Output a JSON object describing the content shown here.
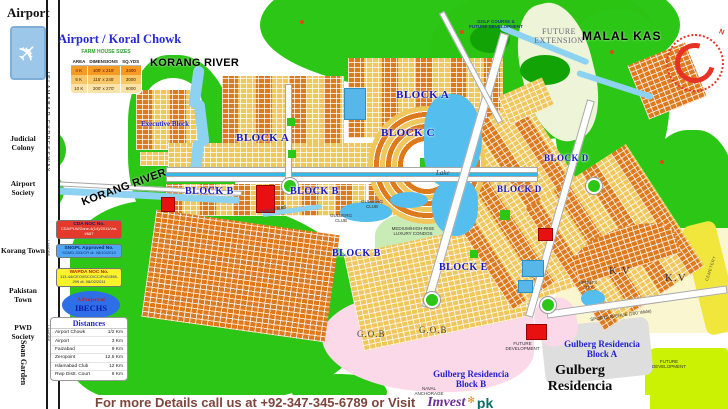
{
  "panel": {
    "airport": "Airport",
    "title": "Airport / Koral Chowk",
    "farm_table": {
      "caption": "FARM HOUSE SIZES",
      "headers": [
        "AREA",
        "DIMENSIONS",
        "SQ.YDS"
      ],
      "rows": [
        [
          "4 K",
          "100' x 216'",
          "2400"
        ],
        [
          "5 K",
          "115' x 245'",
          "3000"
        ],
        [
          "10 K",
          "200' x 270'",
          "6000"
        ]
      ]
    }
  },
  "left_strip": {
    "expressway": "ISLAMABAD EXPRESSWAY",
    "direction_tag": "LAHORE",
    "localities": [
      "Judicial\nColony",
      "Airport\nSociety",
      "Korang Town",
      "Pakistan Town",
      "PWD\nSociety",
      "Soan Garden"
    ]
  },
  "noc": [
    {
      "title": "CDA NOC No.",
      "detail": "CDA/PLW/Zone-4(14)/2011/Vol-I/687"
    },
    {
      "title": "SNGPL Approved No.",
      "detail": "SGMD-333/CR dt. 08/10/2010"
    },
    {
      "title": "WAPDA NOC No.",
      "detail": "113-44/CEO/ISCO/CC/PdG/398-299 dt. 08/02/2011"
    }
  ],
  "project_badge": {
    "line1": "A Project of",
    "line2": "IBECHS"
  },
  "distances": {
    "title": "Distances",
    "rows": [
      [
        "Airport Chowk",
        "1/2 Km"
      ],
      [
        "Airport",
        "3 Km"
      ],
      [
        "Faizabad",
        "9 Km"
      ],
      [
        "Zeropoint",
        "12.5 Km"
      ],
      [
        "Islamabad Club",
        "12 Km"
      ],
      [
        "Rwp Distt. Court",
        "8 Km"
      ]
    ]
  },
  "footer": {
    "text": "For more Details call us at +92-347-345-6789 or Visit",
    "logo_text": "Imvest",
    "logo_flower": "✻",
    "logo_suffix": "pk"
  },
  "map": {
    "compass_north": "N",
    "colors": {
      "green": "#2CC716",
      "plot_orange": "#DD7A1E",
      "plot_sand": "#EFC75D",
      "water": "#54BFEE",
      "gob_pink": "#FBD9E9",
      "future_chartreuse": "#CCF203",
      "title_blue": "#2828D8",
      "block_label_blue": "#1818C8"
    },
    "labels": [
      {
        "name": "korang-river-top-label",
        "text": "KORANG RIVER",
        "x": 150,
        "y": 57,
        "cls": "c-river"
      },
      {
        "name": "korang-river-left-label",
        "text": "KORANG RIVER",
        "x": 80,
        "y": 197,
        "cls": "c-river",
        "rot": -20
      },
      {
        "name": "malal-kas-label",
        "text": "MALAL KAS",
        "x": 582,
        "y": 29,
        "cls": "c-river c-river12"
      },
      {
        "name": "future-extension-label",
        "text": "FUTURE\nEXTENSION",
        "x": 528,
        "y": 27,
        "cls": "c-future",
        "w": 62
      },
      {
        "name": "golf-course-label",
        "text": "GOLF COURSE &\nFUTURE DEVELOPMENT",
        "x": 452,
        "y": 19,
        "cls": "c-navy",
        "w": 88
      },
      {
        "name": "executive-block-label",
        "text": "Executive Block",
        "x": 141,
        "y": 120,
        "cls": "c-exec"
      },
      {
        "name": "block-a-label-1",
        "text": "BLOCK A",
        "x": 236,
        "y": 132,
        "cls": "c-blk"
      },
      {
        "name": "block-a-label-2",
        "text": "BLOCK A",
        "x": 396,
        "y": 89,
        "cls": "c-blk"
      },
      {
        "name": "block-b-label-1",
        "text": "BLOCK B",
        "x": 185,
        "y": 186,
        "cls": "c-blk c-blk10"
      },
      {
        "name": "block-b-label-2",
        "text": "BLOCK B",
        "x": 290,
        "y": 186,
        "cls": "c-blk c-blk10"
      },
      {
        "name": "block-b-label-3",
        "text": "BLOCK B",
        "x": 332,
        "y": 248,
        "cls": "c-blk c-blk10"
      },
      {
        "name": "block-c-label",
        "text": "BLOCK C",
        "x": 381,
        "y": 127,
        "cls": "c-blk"
      },
      {
        "name": "block-d-label-1",
        "text": "BLOCK D",
        "x": 544,
        "y": 153,
        "cls": "c-blk c-blk9"
      },
      {
        "name": "block-d-label-2",
        "text": "BLOCK D",
        "x": 497,
        "y": 184,
        "cls": "c-blk c-blk9"
      },
      {
        "name": "block-e-label",
        "text": "BLOCK E",
        "x": 439,
        "y": 262,
        "cls": "c-blk c-blk10"
      },
      {
        "name": "lake-label",
        "text": "Lake",
        "x": 436,
        "y": 169,
        "cls": "c-lake"
      },
      {
        "name": "gulberg-club-label-1",
        "text": "GULBERG\nCLUB",
        "x": 357,
        "y": 199,
        "cls": "c-tiny",
        "w": 30
      },
      {
        "name": "gulberg-club-label-2",
        "text": "GULBERG\nCLUB",
        "x": 326,
        "y": 213,
        "cls": "c-tiny",
        "w": 30
      },
      {
        "name": "condos-label",
        "text": "MEDIUM/HIGH-RISE\nLUXURY CONDOS",
        "x": 382,
        "y": 226,
        "cls": "c-tiny",
        "w": 62
      },
      {
        "name": "kv-label-1",
        "text": "K.V",
        "x": 609,
        "y": 265,
        "cls": "c-kv"
      },
      {
        "name": "kv-label-2",
        "text": "K.V",
        "x": 665,
        "y": 272,
        "cls": "c-kv"
      },
      {
        "name": "sports-city-label",
        "text": "SPORTS\nCITY",
        "x": 574,
        "y": 280,
        "cls": "c-tiny",
        "w": 28
      },
      {
        "name": "sports-avenue-label",
        "text": "SPORTS AVENUE (200' Wide)",
        "x": 590,
        "y": 317,
        "cls": "c-tiny",
        "rot": -8
      },
      {
        "name": "gob-label-1",
        "text": "G.O.B",
        "x": 357,
        "y": 329,
        "cls": "c-gob"
      },
      {
        "name": "gob-label-2",
        "text": "G.O.B",
        "x": 419,
        "y": 325,
        "cls": "c-gob"
      },
      {
        "name": "gulberg-residencia-block-a-label",
        "text": "Gulberg Residencia\nBlock A",
        "x": 556,
        "y": 339,
        "cls": "c-bluesm",
        "w": 92
      },
      {
        "name": "gulberg-residencia-block-b-label",
        "text": "Gulberg Residencia\nBlock B",
        "x": 425,
        "y": 369,
        "cls": "c-bluesm",
        "w": 92
      },
      {
        "name": "gulberg-residencia-label",
        "text": "Gulberg\nResidencia",
        "x": 545,
        "y": 363,
        "cls": "c-bigblk",
        "w": 70
      },
      {
        "name": "future-development-label-1",
        "text": "FUTURE\nDEVELOPMENT",
        "x": 500,
        "y": 341,
        "cls": "c-tiny",
        "w": 45
      },
      {
        "name": "future-development-label-2",
        "text": "FUTURE\nDEVELOPMENT",
        "x": 648,
        "y": 359,
        "cls": "c-tiny",
        "w": 42
      },
      {
        "name": "naval-anchorage-label",
        "text": "NAVAL\nANCHORAGE",
        "x": 412,
        "y": 386,
        "cls": "c-tiny",
        "w": 34
      },
      {
        "name": "cemetery-label",
        "text": "CEMETERY",
        "x": 704,
        "y": 280,
        "cls": "c-cem",
        "rot": -72
      },
      {
        "name": "malal-kas-stream-label",
        "text": "MALAL KAS",
        "x": 260,
        "y": 209,
        "cls": "c-stream",
        "rot": -10
      }
    ]
  }
}
